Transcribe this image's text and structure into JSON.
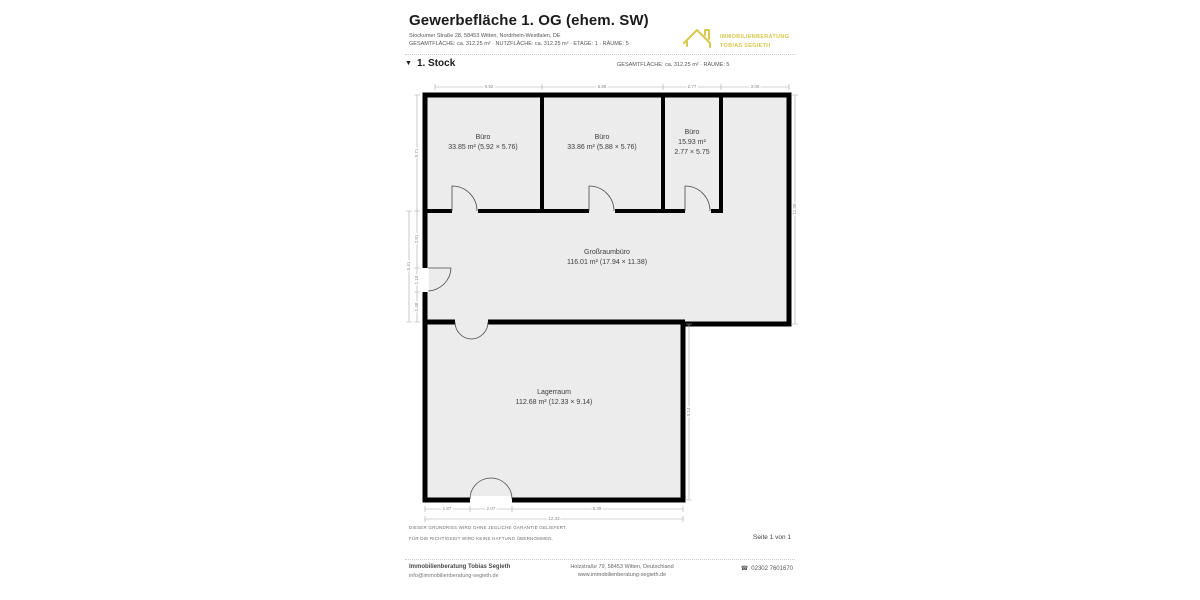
{
  "header": {
    "title": "Gewerbefläche 1. OG (ehem. SW)",
    "address": "Stockumer Straße 28, 58453 Witten, Nordrhein-Westfalen, DE",
    "meta": "GESAMTFLÄCHE: ca. 312.25 m² · NUTZFLÄCHE: ca. 312.25 m² · ETAGE: 1 · RÄUME: 5",
    "logo": {
      "line1": "IMMOBILIENBERATUNG",
      "line2": "TOBIAS SEGIETH",
      "color": "#d8c84d"
    }
  },
  "section": {
    "title": "1. Stock",
    "meta": "GESAMTFLÄCHE: ca. 312.25 m² · RÄUME: 5"
  },
  "icons": {
    "collapse": "▼",
    "phone": "☎",
    "logo_house": "house-outline"
  },
  "rooms": {
    "buero1": {
      "name": "Büro",
      "dims": "33.85 m² (5.92 × 5.76)"
    },
    "buero2": {
      "name": "Büro",
      "dims": "33.86 m² (5.88 × 5.76)"
    },
    "buero3": {
      "name": "Büro",
      "area": "15.93 m²",
      "dims": "2.77 × 5.75"
    },
    "grossraum": {
      "name": "Großraumbüro",
      "dims": "116.01 m² (17.94 × 11.38)"
    },
    "lager": {
      "name": "Lagerraum",
      "dims": "112.68 m² (12.33 × 9.14)"
    }
  },
  "dim_labels": {
    "top": [
      "5.92",
      "5.88",
      "2.77",
      "3.06"
    ],
    "left": [
      "5.71",
      "2.81",
      "1.18",
      "1.48"
    ],
    "left_total": "5.41",
    "right": "11.38",
    "right_lager": "9.14",
    "bottom": [
      "1.87",
      "2.07",
      "8.39"
    ],
    "bottom_total": "12.33"
  },
  "colors": {
    "wall": "#000000",
    "room_fill": "#ececec",
    "dimension": "#9a9a9a"
  },
  "disclaimer": {
    "line1": "DIESER GRUNDRISS WIRD OHNE JEGLICHE GARANTIE GELIEFERT.",
    "line2": "FÜR DIE RICHTIGKEIT WIRD KEINE HAFTUNG ÜBERNOMMEN."
  },
  "page_info": "Seite 1 von 1",
  "footer": {
    "company": "Immobilienberatung Tobias Segieth",
    "email": "info@immobilienberatung-segieth.de",
    "address": "Holzstraße 79, 58453 Witten, Deutschland",
    "website": "www.immobilienberatung-segieth.de",
    "phone": "02302 7601670"
  }
}
